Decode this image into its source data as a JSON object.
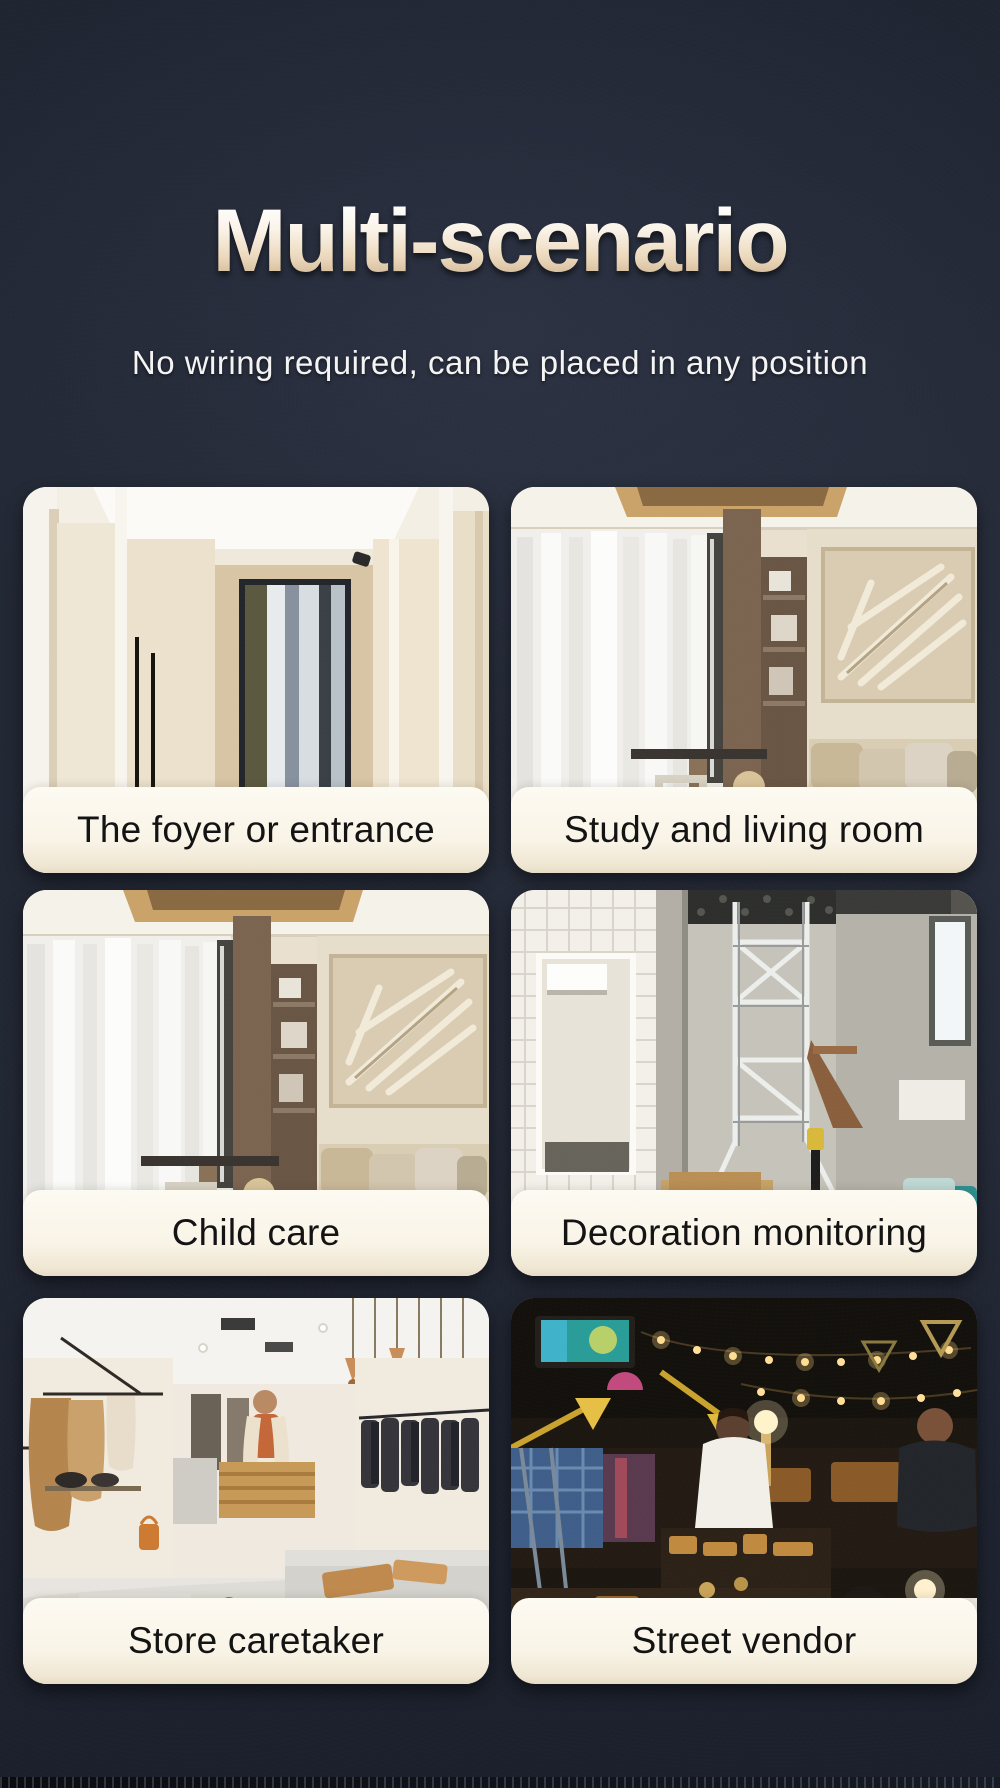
{
  "page": {
    "title": "Multi-scenario",
    "subtitle": "No wiring required, can be placed in any position"
  },
  "cards": [
    {
      "label": "The foyer or entrance",
      "image": "foyer-hallway-photo"
    },
    {
      "label": "Study and living room",
      "image": "living-room-photo"
    },
    {
      "label": "Child care",
      "image": "living-room-photo"
    },
    {
      "label": "Decoration monitoring",
      "image": "construction-site-photo"
    },
    {
      "label": "Store caretaker",
      "image": "clothing-store-photo"
    },
    {
      "label": "Street vendor",
      "image": "night-market-photo"
    }
  ],
  "colors": {
    "background_navy": "#222734",
    "title_gradient_top": "#ffffff",
    "title_gradient_bottom": "#c8ad8b",
    "subtitle_text": "#f4f4f4",
    "label_panel": "#f9f4e7",
    "label_text": "#131313"
  }
}
